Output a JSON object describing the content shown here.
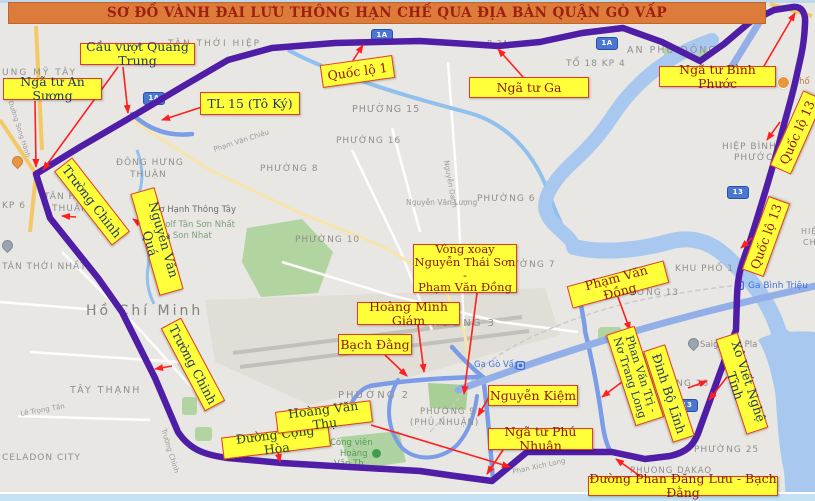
{
  "title": {
    "text": "SƠ ĐỒ VÀNH ĐAI LƯU THÔNG HẠN CHẾ QUA ĐỊA BÀN QUẬN GÒ VẤP"
  },
  "colors": {
    "bg": "#e8e7e3",
    "water": "#a9c8ef",
    "route_purple": "#4f1da6",
    "road_blue": "#7b9ce6",
    "road_blue_wide": "#93afe8",
    "arrow": "#ff1f1f",
    "label_bg": "#ffff3a",
    "label_border": "#e23b28",
    "red": "#8e1508",
    "navy": "#1f3864",
    "green": "#2f4413",
    "title_bg": "#dd7b3a",
    "title_text": "#9c1f10",
    "map_gray": "#8f8f8f",
    "rail_blue": "#4071d9",
    "shield_blue": "#4a77d4"
  },
  "annotations": [
    {
      "id": "cau-vuot-quang-trung",
      "lines": [
        "Cầu vượt Quang Trung"
      ],
      "color": "navy",
      "box": {
        "x": 80,
        "y": 43,
        "w": 115,
        "h": 22,
        "r": 0
      },
      "arrows": [
        [
          123,
          67,
          128,
          113
        ],
        [
          118,
          67,
          43,
          170
        ]
      ]
    },
    {
      "id": "nga-tu-an-suong",
      "lines": [
        "Ngã tư An Sương"
      ],
      "color": "navy",
      "box": {
        "x": 3,
        "y": 78,
        "w": 99,
        "h": 22,
        "r": 0
      },
      "arrows": [
        [
          35,
          101,
          36,
          167
        ]
      ]
    },
    {
      "id": "tl-15-to-ky",
      "lines": [
        "TL 15 (Tô Ký)"
      ],
      "color": "navy",
      "box": {
        "x": 200,
        "y": 92,
        "w": 100,
        "h": 23,
        "r": 0
      },
      "arrows": [
        [
          202,
          107,
          162,
          120
        ]
      ]
    },
    {
      "id": "quoc-lo-1",
      "lines": [
        "Quốc lộ 1"
      ],
      "color": "red",
      "box": {
        "x": 321,
        "y": 60,
        "w": 73,
        "h": 23,
        "r": -8
      },
      "arrows": [
        [
          352,
          62,
          363,
          45
        ]
      ]
    },
    {
      "id": "nga-tu-ga",
      "lines": [
        "Ngã tư Ga"
      ],
      "color": "red",
      "box": {
        "x": 469,
        "y": 77,
        "w": 120,
        "h": 21,
        "r": 0
      },
      "arrows": [
        [
          523,
          77,
          498,
          49
        ]
      ]
    },
    {
      "id": "nga-tu-binh-phuoc",
      "lines": [
        "Ngã tư Bình Phước"
      ],
      "color": "red",
      "box": {
        "x": 659,
        "y": 66,
        "w": 117,
        "h": 21,
        "r": 0
      },
      "arrows": [
        [
          764,
          66,
          795,
          13
        ]
      ]
    },
    {
      "id": "quoc-lo-13-north",
      "lines": [
        "Quốc lộ 13"
      ],
      "color": "red",
      "box": {
        "x": 756,
        "y": 121,
        "w": 82,
        "h": 23,
        "r": -66
      },
      "arrows": [
        [
          780,
          122,
          767,
          140
        ]
      ]
    },
    {
      "id": "quoc-lo-13-south",
      "lines": [
        "Quốc lộ 13"
      ],
      "color": "red",
      "box": {
        "x": 727,
        "y": 225,
        "w": 78,
        "h": 23,
        "r": -70
      },
      "arrows": [
        [
          752,
          238,
          741,
          248
        ]
      ]
    },
    {
      "id": "pham-van-dong",
      "lines": [
        "Phạm Văn Đồng"
      ],
      "color": "red",
      "box": {
        "x": 568,
        "y": 273,
        "w": 100,
        "h": 23,
        "r": -15
      },
      "arrows": [
        [
          618,
          297,
          630,
          330
        ]
      ]
    },
    {
      "id": "vong-xoay-nguyen-thai-son",
      "lines": [
        "Vòng xoay",
        "Nguyễn Thái Sơn -",
        "Phạm Văn Đồng"
      ],
      "color": "red",
      "fs": 11.5,
      "box": {
        "x": 413,
        "y": 244,
        "w": 104,
        "h": 49,
        "r": 0
      },
      "arrows": [
        [
          477,
          293,
          464,
          394
        ]
      ]
    },
    {
      "id": "hoang-minh-giam",
      "lines": [
        "Hoàng Minh Giám"
      ],
      "color": "red",
      "box": {
        "x": 357,
        "y": 302,
        "w": 103,
        "h": 23,
        "r": 0
      },
      "arrows": [
        [
          418,
          325,
          424,
          372
        ]
      ]
    },
    {
      "id": "bach-dang",
      "lines": [
        "Bạch Đằng"
      ],
      "color": "red",
      "box": {
        "x": 338,
        "y": 334,
        "w": 74,
        "h": 21,
        "r": 0
      },
      "arrows": [
        [
          385,
          355,
          407,
          376
        ]
      ]
    },
    {
      "id": "truong-chinh-north",
      "lines": [
        "Trường Chinh"
      ],
      "color": "navy",
      "box": {
        "x": 45,
        "y": 190,
        "w": 94,
        "h": 23,
        "r": 52
      },
      "arrows": [
        [
          76,
          217,
          62,
          216
        ]
      ]
    },
    {
      "id": "nguyen-van-qua",
      "lines": [
        "Nguyễn Văn Quá"
      ],
      "color": "navy",
      "box": {
        "x": 104,
        "y": 229,
        "w": 106,
        "h": 25,
        "r": 74
      },
      "arrows": [
        [
          146,
          228,
          133,
          219
        ]
      ]
    },
    {
      "id": "truong-chinh-south",
      "lines": [
        "Trường Chinh"
      ],
      "color": "navy",
      "box": {
        "x": 146,
        "y": 353,
        "w": 94,
        "h": 23,
        "r": 62
      },
      "arrows": [
        [
          172,
          366,
          155,
          369
        ]
      ]
    },
    {
      "id": "duong-cong-hoa",
      "lines": [
        "Đường Cộng Hòa"
      ],
      "color": "green",
      "box": {
        "x": 222,
        "y": 431,
        "w": 108,
        "h": 22,
        "r": -7
      },
      "arrows": [
        [
          278,
          452,
          280,
          462
        ]
      ]
    },
    {
      "id": "hoang-van-thu",
      "lines": [
        "Hoàng Văn Thụ"
      ],
      "color": "green",
      "box": {
        "x": 276,
        "y": 406,
        "w": 96,
        "h": 22,
        "r": -7
      },
      "arrows": [
        [
          371,
          425,
          510,
          467
        ]
      ]
    },
    {
      "id": "nguyen-kiem",
      "lines": [
        "Nguyễn Kiệm"
      ],
      "color": "red",
      "box": {
        "x": 488,
        "y": 385,
        "w": 90,
        "h": 21,
        "r": 0
      },
      "arrows": [
        [
          489,
          397,
          478,
          416
        ]
      ]
    },
    {
      "id": "nga-tu-phu-nhuan",
      "lines": [
        "Ngã tư Phú Nhuận"
      ],
      "color": "red",
      "box": {
        "x": 488,
        "y": 428,
        "w": 105,
        "h": 22,
        "r": 0
      },
      "arrows": [
        [
          503,
          450,
          487,
          474
        ]
      ]
    },
    {
      "id": "phan-van-tri-no-trang-long",
      "lines": [
        "Phan Văn Trị -",
        "Nơ Trang Long"
      ],
      "color": "navy",
      "fs": 11,
      "box": {
        "x": 587,
        "y": 361,
        "w": 96,
        "h": 30,
        "r": 72
      },
      "arrows": [
        [
          622,
          382,
          602,
          397
        ]
      ]
    },
    {
      "id": "dinh-bo-linh",
      "lines": [
        "Đinh Bộ Lĩnh"
      ],
      "color": "navy",
      "box": {
        "x": 621,
        "y": 382,
        "w": 96,
        "h": 23,
        "r": 72
      },
      "arrows": [
        [
          688,
          388,
          707,
          381
        ]
      ]
    },
    {
      "id": "xo-viet-nghe-tinh",
      "lines": [
        "Xô Viết Nghệ Tĩnh"
      ],
      "color": "navy",
      "box": {
        "x": 692,
        "y": 372,
        "w": 100,
        "h": 23,
        "r": 72
      },
      "arrows": [
        [
          727,
          377,
          709,
          400
        ]
      ]
    },
    {
      "id": "duong-phan-dang-luu-bach-dang",
      "lines": [
        "Đường Phan Đăng Lưu - Bạch Đằng"
      ],
      "color": "red",
      "box": {
        "x": 588,
        "y": 476,
        "w": 190,
        "h": 20,
        "r": 0
      },
      "arrows": [
        [
          640,
          476,
          616,
          459
        ]
      ]
    }
  ],
  "map_texts": [
    {
      "t": "TÂN THỚI HIỆP",
      "x": 168,
      "y": 40,
      "ls": 2
    },
    {
      "t": "UNG MỸ TÂY",
      "x": 2,
      "y": 69,
      "ls": 2
    },
    {
      "t": "P 3A",
      "x": 487,
      "y": 40,
      "s": 8
    },
    {
      "t": "TỔ 18  KP 4",
      "x": 566,
      "y": 60
    },
    {
      "t": "AN PHÚ ĐÔNG",
      "x": 627,
      "y": 46,
      "s": 9.5,
      "ls": 2
    },
    {
      "t": "HIỆP BÌNH",
      "x": 722,
      "y": 143
    },
    {
      "t": "PHƯỚC",
      "x": 734,
      "y": 154
    },
    {
      "t": "ĐÔNG HƯNG",
      "x": 116,
      "y": 159
    },
    {
      "t": "THUẬN",
      "x": 130,
      "y": 171
    },
    {
      "t": "TÂN HƯNG",
      "x": 44,
      "y": 193
    },
    {
      "t": "THUẬN",
      "x": 52,
      "y": 205
    },
    {
      "t": "KP 6",
      "x": 2,
      "y": 202
    },
    {
      "t": "TÂN THỚI NHẤT",
      "x": 2,
      "y": 263
    },
    {
      "t": "Hồ Chí Minh",
      "x": 86,
      "y": 304,
      "s": 14,
      "c": "#828282",
      "ls": 3
    },
    {
      "t": "TÂY THẠNH",
      "x": 70,
      "y": 386,
      "s": 9.5,
      "ls": 2
    },
    {
      "t": "CELADON CITY",
      "x": 2,
      "y": 454
    },
    {
      "t": "PHƯỜNG 15",
      "x": 352,
      "y": 105,
      "s": 9.5
    },
    {
      "t": "PHƯỜNG 16",
      "x": 336,
      "y": 137
    },
    {
      "t": "PHƯỜNG 8",
      "x": 260,
      "y": 165
    },
    {
      "t": "PHƯỜNG 6",
      "x": 477,
      "y": 195
    },
    {
      "t": "PHƯỜNG 10",
      "x": 295,
      "y": 236
    },
    {
      "t": "PHƯỜNG 7",
      "x": 497,
      "y": 261
    },
    {
      "t": "PHƯỜNG 3",
      "x": 424,
      "y": 319,
      "s": 10,
      "ls": 2
    },
    {
      "t": "PHƯỜNG 13",
      "x": 614,
      "y": 289
    },
    {
      "t": "KHU PHỐ 1",
      "x": 675,
      "y": 265
    },
    {
      "t": "PHƯỜNG 2",
      "x": 338,
      "y": 391,
      "s": 10,
      "ls": 2
    },
    {
      "t": "PHƯỜNG 9",
      "x": 420,
      "y": 408,
      "s": 8.5
    },
    {
      "t": "(PHÚ NHUẬN)",
      "x": 410,
      "y": 419,
      "s": 8.5
    },
    {
      "t": "PHƯỜNG 26",
      "x": 644,
      "y": 380
    },
    {
      "t": "PHƯỜNG 25",
      "x": 694,
      "y": 446
    },
    {
      "t": "PHUONG DAKAO",
      "x": 630,
      "y": 467,
      "s": 8.5
    },
    {
      "t": "Chợ Hạnh Thông Tây",
      "x": 148,
      "y": 206,
      "s": 8.5,
      "c": "#6d6d6d",
      "ls": 0
    },
    {
      "t": "Sân Golf Tân Sơn Nhất",
      "x": 140,
      "y": 221,
      "s": 8.5,
      "c": "#7e9e7a",
      "ls": 0
    },
    {
      "t": "- Tan Son Nhat",
      "x": 150,
      "y": 232,
      "s": 8.5,
      "c": "#7e9e7a",
      "ls": 0
    },
    {
      "t": "Nguyễn Văn Lượng",
      "x": 406,
      "y": 199,
      "s": 7.5,
      "c": "#9a9a9a",
      "ls": 0
    },
    {
      "t": "Ga Bình Triệu",
      "x": 748,
      "y": 282,
      "c": "#4071d9",
      "ls": 0
    },
    {
      "t": "Ga Gò Vấp",
      "x": 474,
      "y": 361,
      "s": 8.5,
      "c": "#4071d9",
      "ls": 0
    },
    {
      "t": "Saigonres Pla",
      "x": 700,
      "y": 341,
      "s": 8.5,
      "c": "#8a8a8a",
      "ls": 0
    },
    {
      "t": "Công viên",
      "x": 330,
      "y": 439,
      "s": 8.5,
      "c": "#569b57",
      "ls": 0
    },
    {
      "t": "Hoàng",
      "x": 340,
      "y": 450,
      "s": 8.5,
      "c": "#569b57",
      "ls": 0
    },
    {
      "t": "Văn Th",
      "x": 334,
      "y": 460,
      "s": 8.5,
      "c": "#569b57",
      "ls": 0
    },
    {
      "t": "Phan Xich Long",
      "x": 512,
      "y": 469,
      "s": 7,
      "c": "#9a9a9a",
      "ls": 0,
      "r": -12
    },
    {
      "t": "Phạm Văn Chiêu",
      "x": 213,
      "y": 147,
      "s": 7,
      "c": "#9a9a9a",
      "ls": 0,
      "r": -18
    },
    {
      "t": "Lê Trọng Tấn",
      "x": 20,
      "y": 411,
      "s": 7,
      "c": "#9a9a9a",
      "ls": 0,
      "r": -10
    },
    {
      "t": "Đường Song Hành",
      "x": 13,
      "y": 100,
      "s": 6.5,
      "c": "#9a9a9a",
      "ls": 0,
      "r": 72
    },
    {
      "t": "Trường Chinh",
      "x": 166,
      "y": 428,
      "s": 7,
      "c": "#9a9a9a",
      "ls": 0,
      "r": 73
    },
    {
      "t": "Nguyễn Oanh",
      "x": 449,
      "y": 160,
      "s": 7,
      "c": "#9a9a9a",
      "ls": 0,
      "r": 80
    },
    {
      "t": "Phố",
      "x": 794,
      "y": 78,
      "s": 8.5,
      "c": "#c07a3a",
      "ls": 0
    },
    {
      "t": "HIỆ",
      "x": 801,
      "y": 228,
      "s": 8
    },
    {
      "t": "CH",
      "x": 803,
      "y": 239,
      "s": 8
    }
  ],
  "shields": [
    {
      "t": "1A",
      "x": 143,
      "y": 92
    },
    {
      "t": "1A",
      "x": 371,
      "y": 29
    },
    {
      "t": "1A",
      "x": 596,
      "y": 37
    },
    {
      "t": "13",
      "x": 727,
      "y": 186
    },
    {
      "t": "13",
      "x": 676,
      "y": 399
    }
  ],
  "pois": [
    {
      "type": "pin",
      "name": "restaurant-pin-icon",
      "x": 12,
      "y": 156,
      "c": "#e8963f"
    },
    {
      "type": "pin",
      "name": "poi-pin-icon",
      "x": 2,
      "y": 240,
      "c": "#9aa5b1"
    },
    {
      "type": "pin",
      "name": "poi-pin-icon",
      "x": 688,
      "y": 338,
      "c": "#9aa5b1"
    },
    {
      "type": "circle",
      "name": "restaurant-dot-icon",
      "x": 777,
      "y": 76,
      "c": "#e8963f"
    },
    {
      "type": "tree",
      "name": "park-tree-icon",
      "x": 372,
      "y": 449,
      "c": "#3f9d4e"
    },
    {
      "type": "rail",
      "name": "train-station-icon",
      "x": 516,
      "y": 361
    },
    {
      "type": "rail",
      "name": "train-station-icon",
      "x": 735,
      "y": 281
    }
  ]
}
